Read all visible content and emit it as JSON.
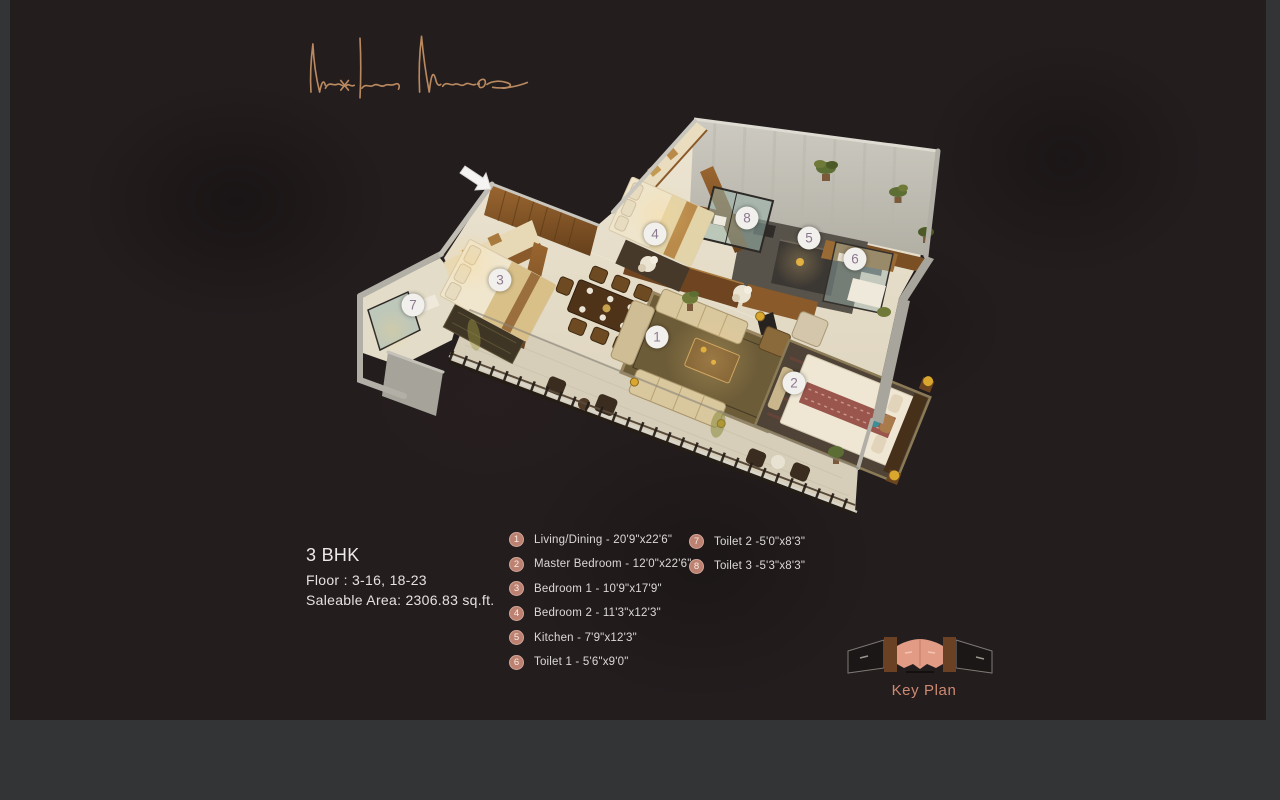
{
  "brand": {
    "name": "Naxria Minar"
  },
  "info": {
    "bhk": "3 BHK",
    "floor": "Floor : 3-16, 18-23",
    "area": "Saleable Area: 2306.83 sq.ft."
  },
  "legend": {
    "columns": [
      {
        "items": [
          {
            "num": "1",
            "label": "Living/Dining - 20'9\"x22'6\""
          },
          {
            "num": "2",
            "label": "Master Bedroom - 12'0\"x22'6\""
          },
          {
            "num": "3",
            "label": "Bedroom 1 - 10'9\"x17'9\""
          },
          {
            "num": "4",
            "label": "Bedroom 2 - 11'3\"x12'3\""
          },
          {
            "num": "5",
            "label": "Kitchen - 7'9\"x12'3\""
          },
          {
            "num": "6",
            "label": "Toilet 1 - 5'6\"x9'0\""
          }
        ]
      },
      {
        "items": [
          {
            "num": "7",
            "label": "Toilet 2 -5'0\"x8'3\""
          },
          {
            "num": "8",
            "label": "Toilet 3 -5'3\"x8'3\""
          }
        ]
      }
    ]
  },
  "plan_markers": [
    {
      "num": "1",
      "x": 657,
      "y": 337
    },
    {
      "num": "2",
      "x": 794,
      "y": 383
    },
    {
      "num": "3",
      "x": 500,
      "y": 280
    },
    {
      "num": "4",
      "x": 655,
      "y": 234
    },
    {
      "num": "5",
      "x": 809,
      "y": 238
    },
    {
      "num": "6",
      "x": 855,
      "y": 259
    },
    {
      "num": "7",
      "x": 413,
      "y": 305
    },
    {
      "num": "8",
      "x": 747,
      "y": 218
    }
  ],
  "keyplan": {
    "label": "Key Plan"
  },
  "icons": {
    "entrance_arrow": "↘"
  },
  "colors": {
    "slide_bg": "#241d1e",
    "frame_bg": "#323436",
    "text_white": "#eceae6",
    "legend_circle": "#bc8170",
    "marker_number": "#8b7990",
    "keyplan_salmon": "#e29b85",
    "keyplan_brown": "#6b4123",
    "signature": "#b9895f"
  }
}
